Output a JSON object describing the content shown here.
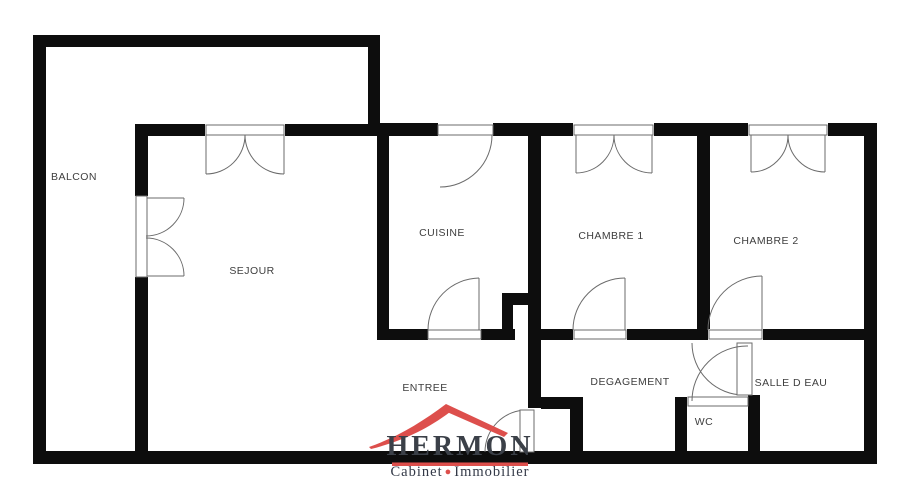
{
  "plan": {
    "title": "apartment floor plan",
    "rooms": [
      {
        "id": "balcon",
        "label": "BALCON"
      },
      {
        "id": "sejour",
        "label": "SEJOUR"
      },
      {
        "id": "cuisine",
        "label": "CUISINE"
      },
      {
        "id": "chambre-1",
        "label": "CHAMBRE 1"
      },
      {
        "id": "chambre-2",
        "label": "CHAMBRE 2"
      },
      {
        "id": "entree",
        "label": "ENTREE"
      },
      {
        "id": "degagement",
        "label": "DEGAGEMENT"
      },
      {
        "id": "salle-d-eau",
        "label": "SALLE D EAU"
      },
      {
        "id": "wc",
        "label": "WC"
      }
    ]
  },
  "logo": {
    "name": "HERMON",
    "tagline_left": "Cabinet",
    "tagline_separator": "●",
    "tagline_right": "Immobilier",
    "accent_color": "#dd4f4c",
    "text_color": "#3b4048"
  },
  "colors": {
    "background": "#ffffff",
    "wall": "#0d0d0d",
    "door_line": "#6b6b6b"
  }
}
